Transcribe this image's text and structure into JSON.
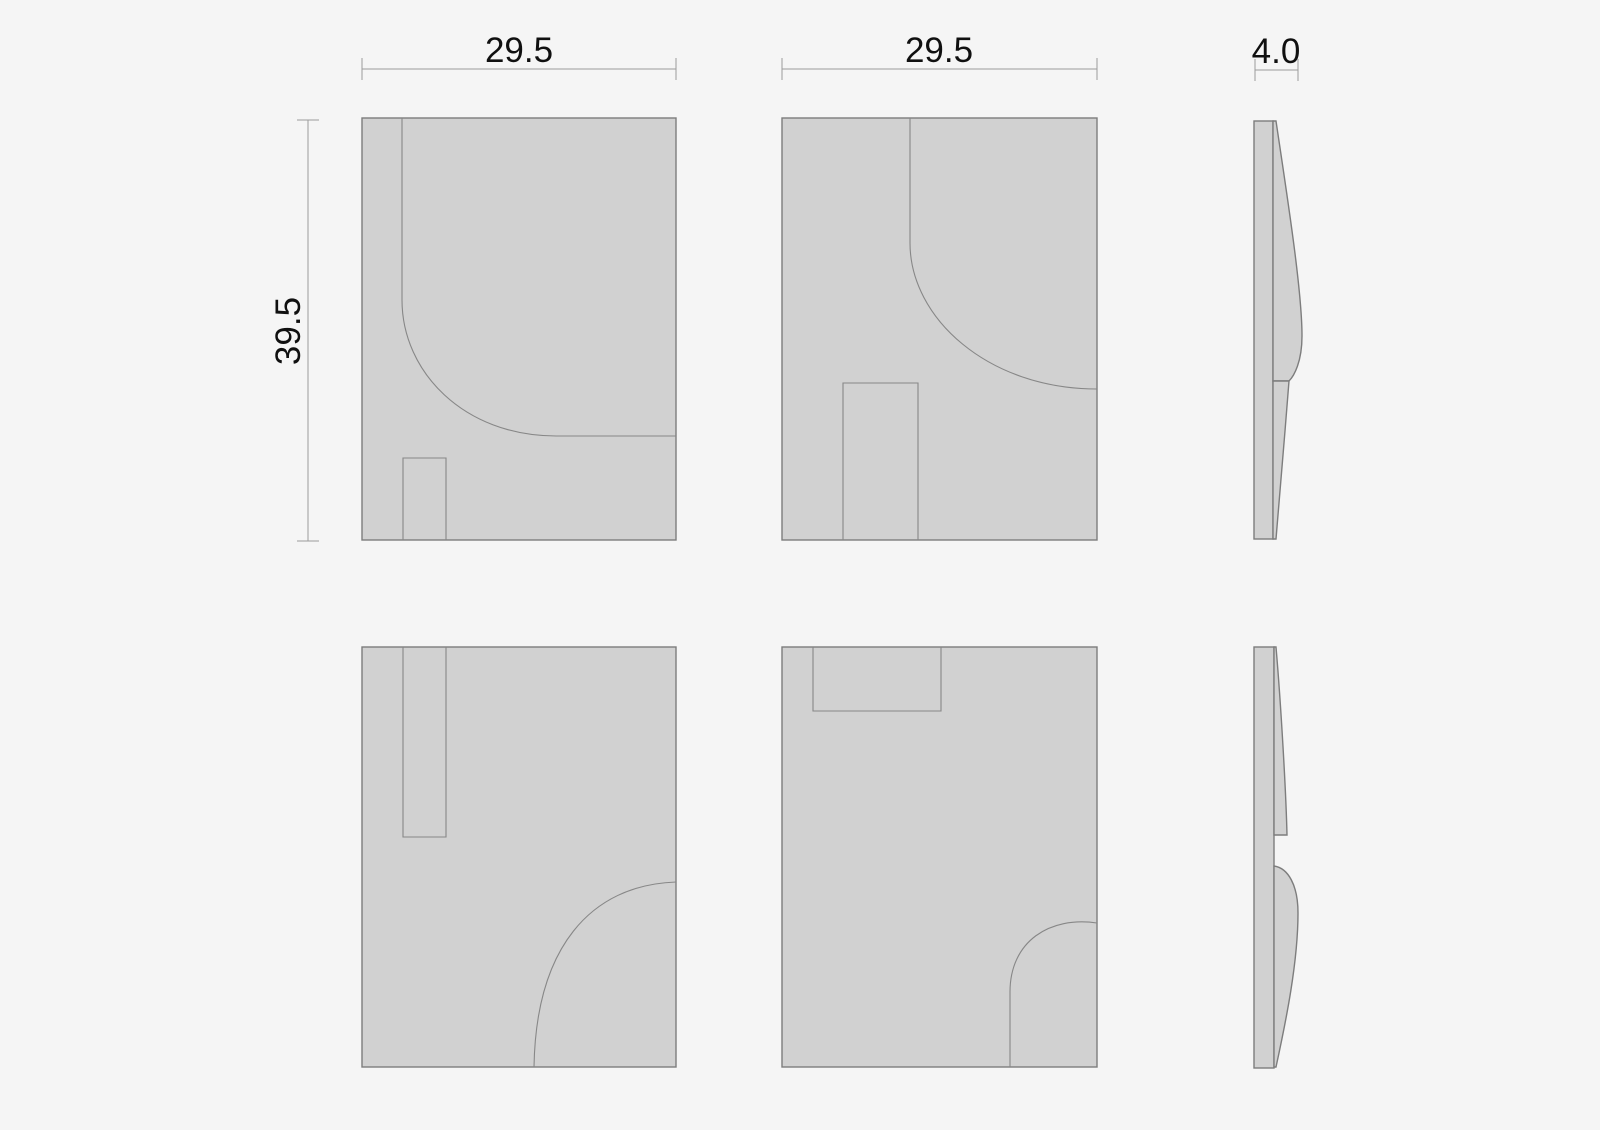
{
  "colors": {
    "background": "#f5f5f5",
    "panel_fill": "#d1d1d1",
    "outline": "#7d7d7d",
    "inner_line": "#878787",
    "dimension_line": "#9c9c9c",
    "dimension_text": "#101010"
  },
  "dimensions": {
    "width_a": "29.5",
    "width_b": "29.5",
    "depth": "4.0",
    "height": "39.5"
  }
}
